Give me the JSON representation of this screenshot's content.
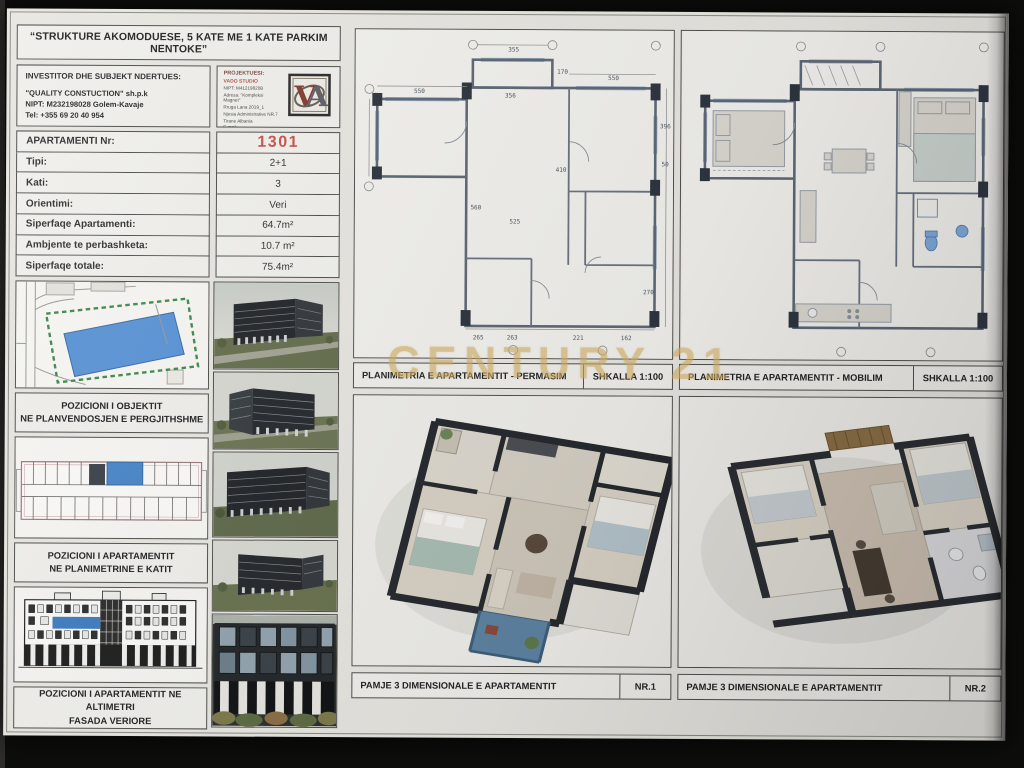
{
  "sheet": {
    "title": "“STRUKTURE AKOMODUESE, 5 KATE ME 1 KATE PARKIM NENTOKE”",
    "watermark": "CENTURY 21"
  },
  "investor": {
    "heading": "INVESTITOR DHE SUBJEKT NDERTUES:",
    "line1": "\"QUALITY CONSTUCTION\" sh.p.k",
    "line2": "NIPT: M232198028 Golem-Kavaje",
    "line3": "Tel: +355 69 20 40 954"
  },
  "designer": {
    "heading": "PROJEKTUESI:",
    "name": "VADO STUDIO",
    "line1": "NIPT: M41219820B",
    "line2": "Adresa: \"Kompleksi Magnet\"",
    "line3": "Rruga Lana 2019_1",
    "line4": "Njesia Administrative NR.7",
    "line5": "Tirane Albania",
    "line6": "E-mail: v.hoxha@metba.studio",
    "line7": "Tel: +355674099452",
    "logo_monogram": "VA"
  },
  "apartment_table": {
    "rows": [
      {
        "label": "APARTAMENTI Nr:",
        "value": "1301"
      },
      {
        "label": "Tipi:",
        "value": "2+1"
      },
      {
        "label": "Kati:",
        "value": "3"
      },
      {
        "label": "Orientimi:",
        "value": "Veri"
      },
      {
        "label": "Siperfaqe Apartamenti:",
        "value": "64.7m²"
      },
      {
        "label": "Ambjente te perbashketa:",
        "value": "10.7 m²"
      },
      {
        "label": "Siperfaqe totale:",
        "value": "75.4m²"
      }
    ]
  },
  "captions": {
    "site": [
      "POZICIONI I OBJEKTIT",
      "NE PLANVENDOSJEN E PERGJITHSHME"
    ],
    "floor": [
      "POZICIONI I APARTAMENTIT",
      "NE PLANIMETRINE E KATIT"
    ],
    "facade": [
      "POZICIONI I APARTAMENTIT NE ALTIMETRI",
      "FASADA VERIORE"
    ]
  },
  "panels": {
    "permasim": {
      "title": "PLANIMETRIA E APARTAMENTIT - PERMASIM",
      "scale": "SHKALLA 1:100"
    },
    "mobilim": {
      "title": "PLANIMETRIA E APARTAMENTIT - MOBILIM",
      "scale": "SHKALLA 1:100"
    },
    "view1": {
      "title": "PAMJE 3 DIMENSIONALE E APARTAMENTIT",
      "nr": "NR.1"
    },
    "view2": {
      "title": "PAMJE 3 DIMENSIONALE E APARTAMENTIT",
      "nr": "NR.2"
    }
  },
  "tech_plan_dims": [
    {
      "t": "550",
      "x": 64,
      "y": 62
    },
    {
      "t": "355",
      "x": 158,
      "y": 20
    },
    {
      "t": "170",
      "x": 207,
      "y": 42
    },
    {
      "t": "356",
      "x": 155,
      "y": 66
    },
    {
      "t": "550",
      "x": 258,
      "y": 48
    },
    {
      "t": "396",
      "x": 310,
      "y": 96
    },
    {
      "t": "50",
      "x": 310,
      "y": 134
    },
    {
      "t": "560",
      "x": 121,
      "y": 178
    },
    {
      "t": "410",
      "x": 206,
      "y": 140
    },
    {
      "t": "525",
      "x": 160,
      "y": 192
    },
    {
      "t": "265",
      "x": 124,
      "y": 308
    },
    {
      "t": "263",
      "x": 158,
      "y": 308
    },
    {
      "t": "221",
      "x": 224,
      "y": 308
    },
    {
      "t": "162",
      "x": 272,
      "y": 308
    },
    {
      "t": "270",
      "x": 294,
      "y": 262
    }
  ],
  "colors": {
    "highlight_blue": "#4a86c8",
    "apartment_number_red": "#c4554e",
    "watermark_gold": "#caa860",
    "boundary_green": "#3f8a4f"
  }
}
